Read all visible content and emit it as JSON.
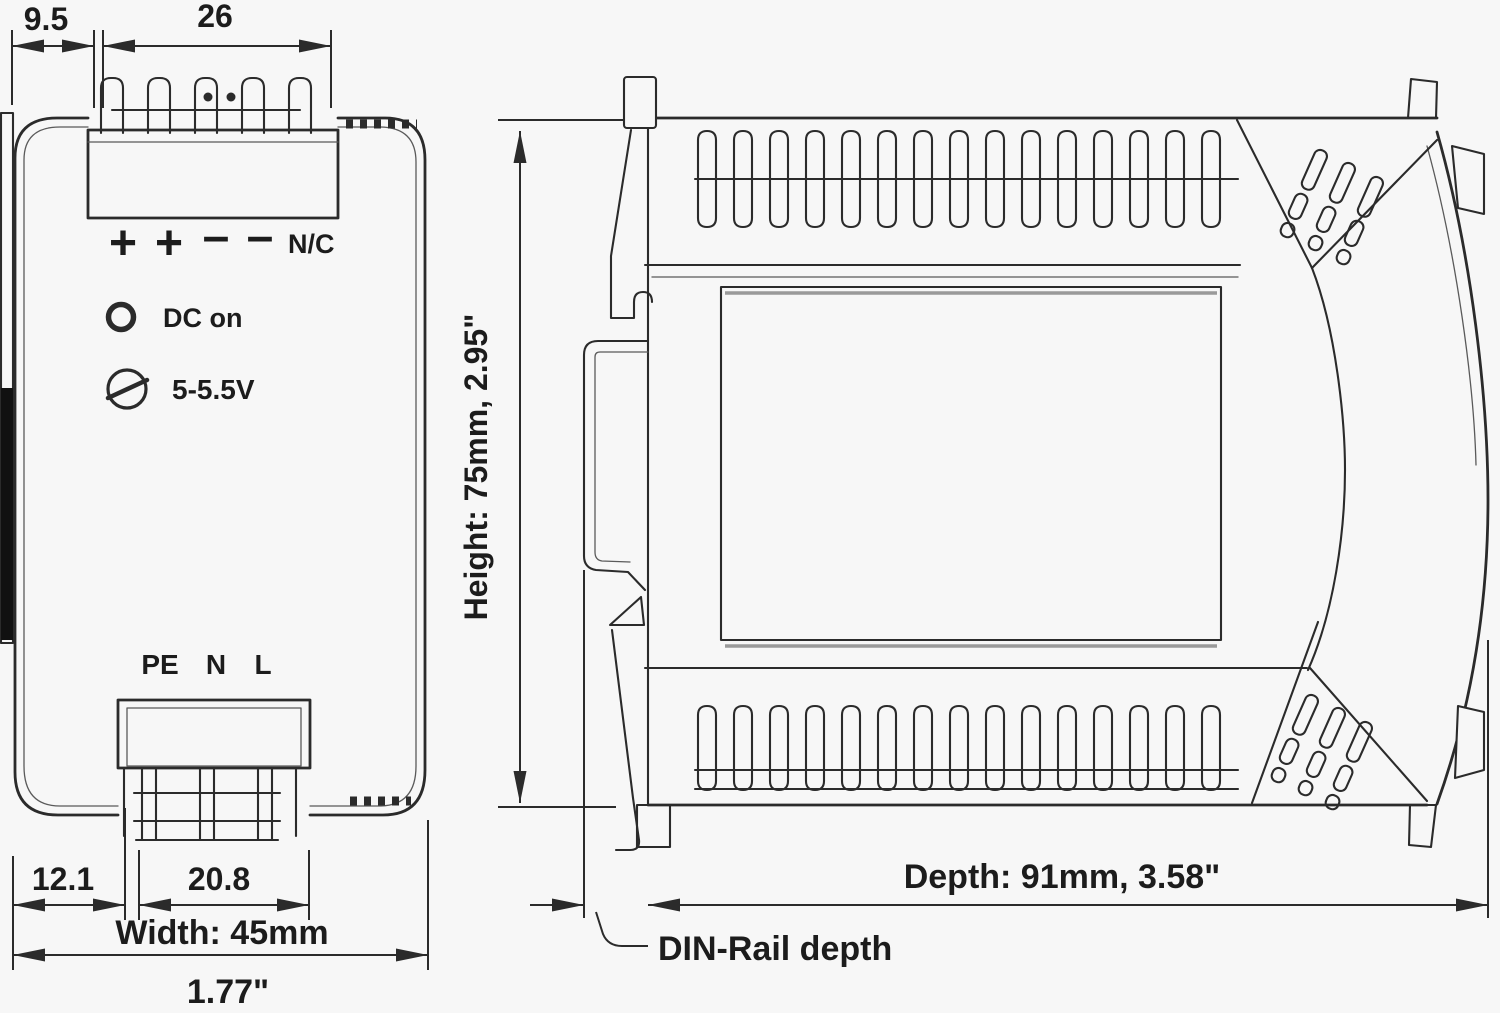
{
  "drawing_title": "DIN-rail power supply dimension drawing",
  "front_view": {
    "dim_rail_offset": "9.5",
    "dim_output_terminal": "26",
    "terminal_plus_1": "+",
    "terminal_plus_2": "+",
    "terminal_minus_1": "–",
    "terminal_minus_2": "–",
    "terminal_nc": "N/C",
    "led_label": "DC on",
    "pot_label": "5-5.5V",
    "terminal_pe": "PE",
    "terminal_n": "N",
    "terminal_l": "L",
    "dim_bottom_left": "12.1",
    "dim_input_terminal": "20.8",
    "width_label": "Width: 45mm",
    "width_inches": "1.77\""
  },
  "side_view": {
    "height_label": "Height: 75mm,  2.95\"",
    "depth_label": "Depth: 91mm,  3.58\"",
    "din_rail_label": "DIN-Rail depth"
  },
  "colors": {
    "line": "#2b2b2b",
    "text": "#1c1c1c",
    "background": "#f7f7f7",
    "din_rail_fill": "#111111"
  }
}
